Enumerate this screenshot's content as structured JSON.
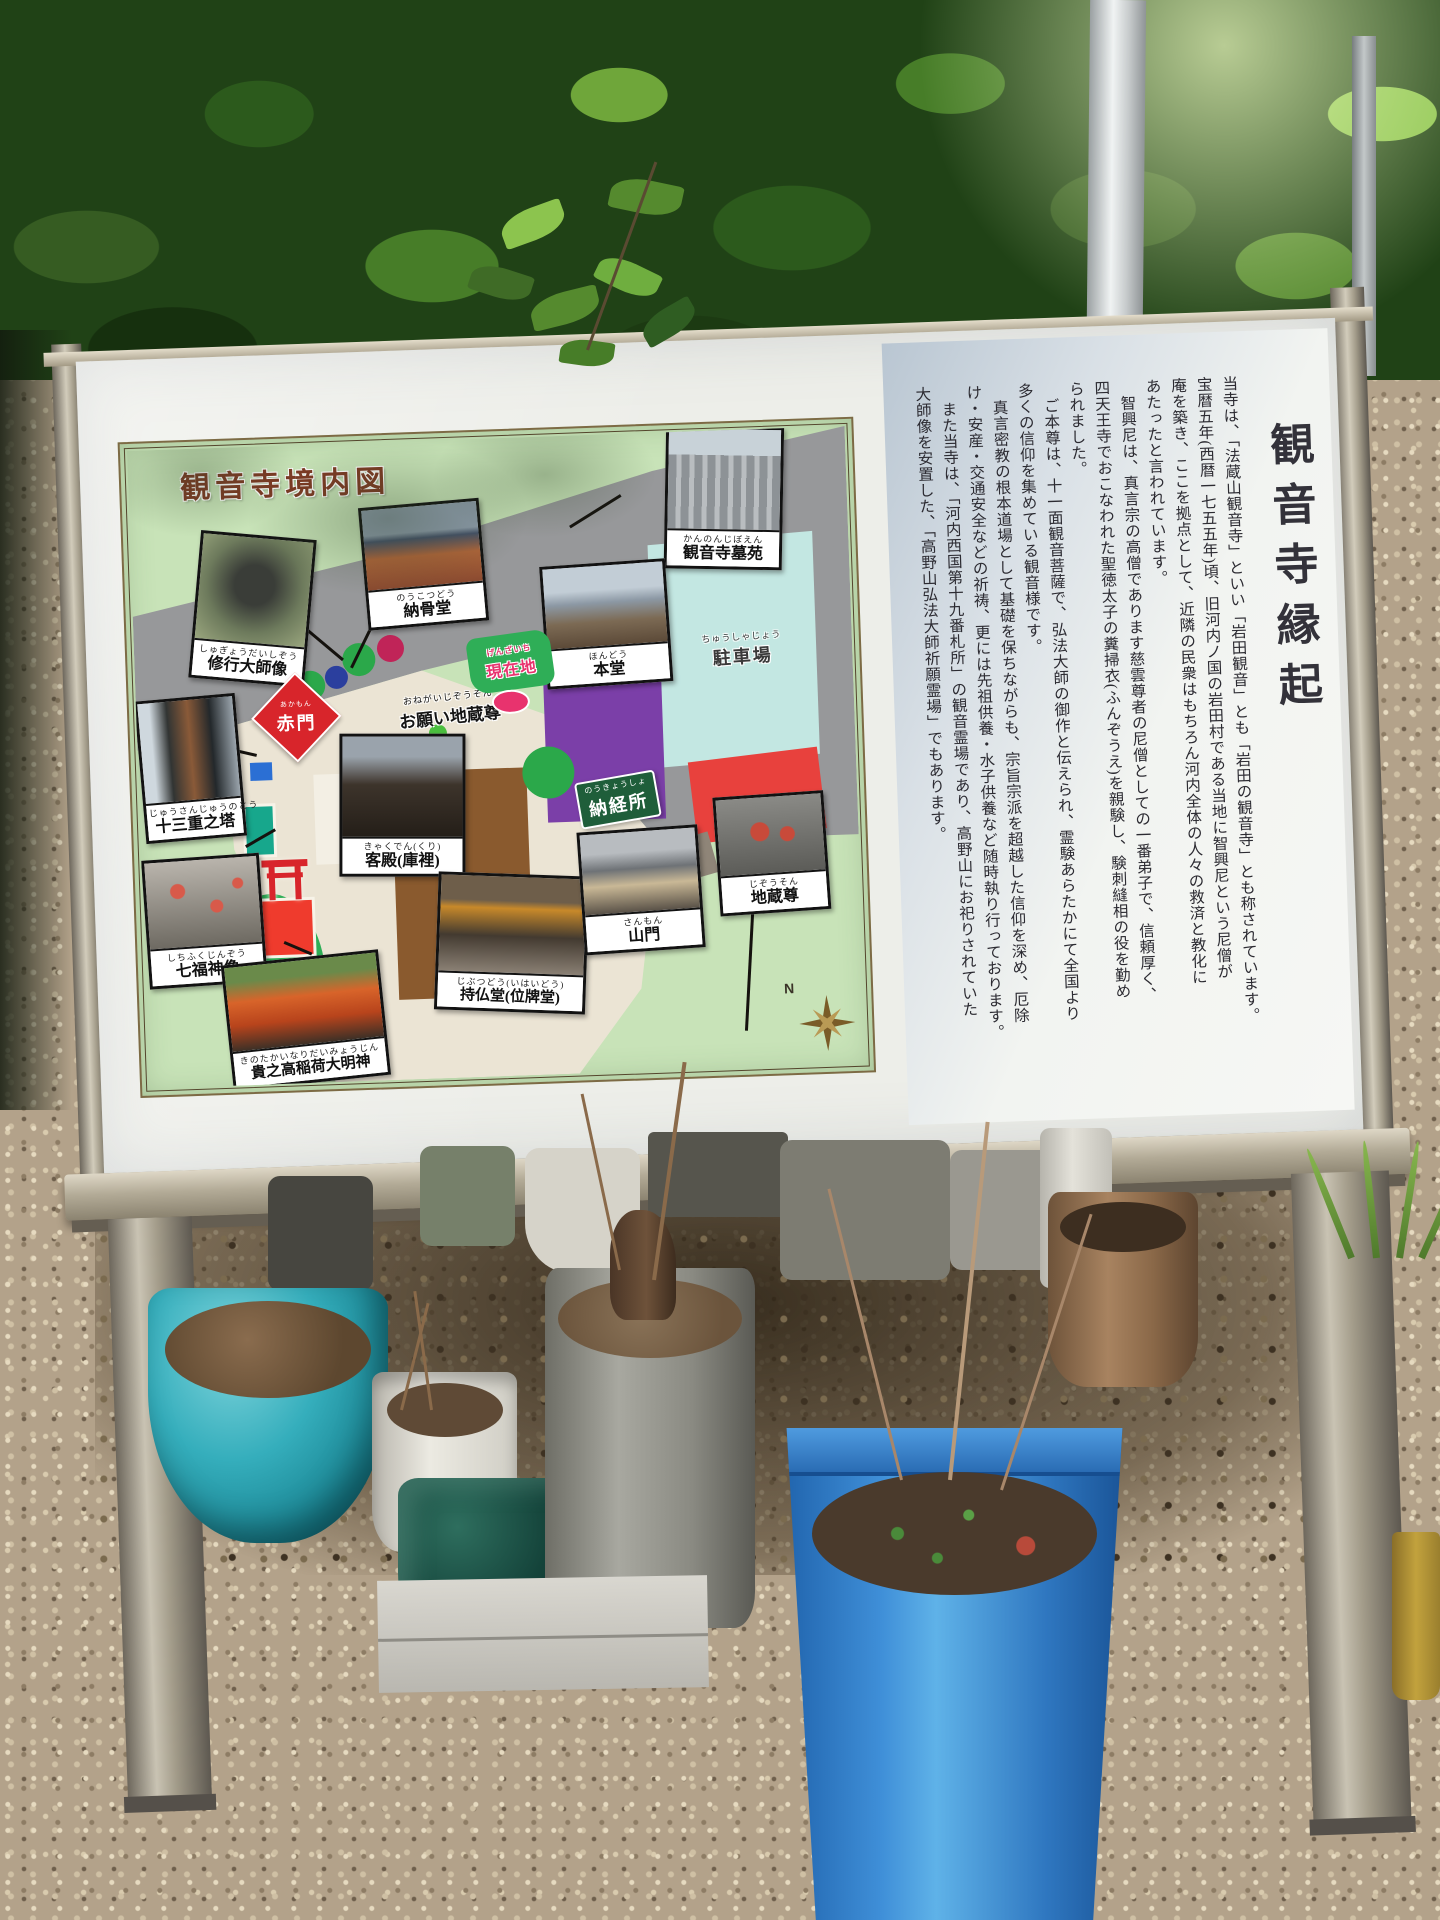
{
  "map": {
    "title": "観音寺境内図",
    "compass": "N",
    "spots": [
      {
        "id": "shugyo-daishi-zo",
        "furigana": "しゅぎょうだいしぞう",
        "label": "修行大師像"
      },
      {
        "id": "nokotsudo",
        "furigana": "のうこつどう",
        "label": "納骨堂"
      },
      {
        "id": "kannonji-boen",
        "furigana": "かんのんじぼえん",
        "label": "観音寺墓苑"
      },
      {
        "id": "hondo",
        "furigana": "ほんどう",
        "label": "本堂"
      },
      {
        "id": "jusanju-no-to",
        "furigana": "じゅうさんじゅうのとう",
        "label": "十三重之塔"
      },
      {
        "id": "shichifukujin-zo",
        "furigana": "しちふくじんぞう",
        "label": "七福神像"
      },
      {
        "id": "kyakuden-kuri",
        "furigana": "きゃくでん(くり)",
        "label": "客殿(庫裡)"
      },
      {
        "id": "kinotaka-inari-daimyojin",
        "furigana": "きのたかいなりだいみょうじん",
        "label": "貴之高稲荷大明神"
      },
      {
        "id": "jibutsudo-ihaido",
        "furigana": "じぶつどう(いはいどう)",
        "label": "持仏堂(位牌堂)"
      },
      {
        "id": "sanmon",
        "furigana": "さんもん",
        "label": "山門"
      },
      {
        "id": "jizoson",
        "furigana": "じぞうそん",
        "label": "地蔵尊"
      }
    ],
    "inline_labels": {
      "akamon": {
        "furigana": "あかもん",
        "label": "赤門"
      },
      "onegai_jizoson": {
        "furigana": "おねがいじぞうそん",
        "label": "お願い地蔵尊"
      },
      "genzaichi": {
        "furigana": "げんざいち",
        "label": "現在地"
      },
      "chushajo": {
        "furigana": "ちゅうしゃじょう",
        "label": "駐車場"
      },
      "nokyosho": {
        "furigana": "のうきょうしょ",
        "label": "納経所"
      }
    }
  },
  "engi": {
    "title": "観音寺縁起",
    "columns": [
      "当寺は、「法蔵山観音寺」といい「岩田観音」とも「岩田の観音寺」とも称されています。",
      "宝暦五年(西暦一七五五年)頃、旧河内ノ国の岩田村である当地に智興尼という尼僧が",
      "庵を築き、ここを拠点として、近隣の民衆はもちろん河内全体の人々の救済と教化に",
      "あたったと言われています。",
      "　智興尼は、真言宗の高僧であります慈雲尊者の尼僧としての一番弟子で、信頼厚く、",
      "四天王寺でおこなわれた聖徳太子の糞掃衣(ふんぞうえ)を親験し、験刺縫相の役を勤め",
      "られました。",
      "　ご本尊は、十一面観音菩薩で、弘法大師の御作と伝えられ、霊験あらたかにて全国より",
      "多くの信仰を集めている観音様です。",
      "　真言密教の根本道場として基礎を保ちながらも、宗旨宗派を超越した信仰を深め、厄除",
      "け・安産・交通安全などの祈祷、更には先祖供養・水子供養など随時執り行っております。",
      "　また当寺は、「河内西国第十九番札所」の観音霊場であり、高野山にお祀りされていた",
      "大師像を安置した、「高野山弘法大師祈願霊場」でもあります。"
    ]
  },
  "colors": {
    "map_background": "#c8e3b8",
    "road_gray": "#97989a",
    "parking_blue": "#c3e7e2",
    "hondo_purple": "#7b3fa8",
    "akamon_red": "#d8252b",
    "nokyosho_green": "#1f5e3a",
    "genzaichi_pink": "#e8336e",
    "blue_pot": "#2f7fc4",
    "teal_pot": "#35aebc"
  }
}
